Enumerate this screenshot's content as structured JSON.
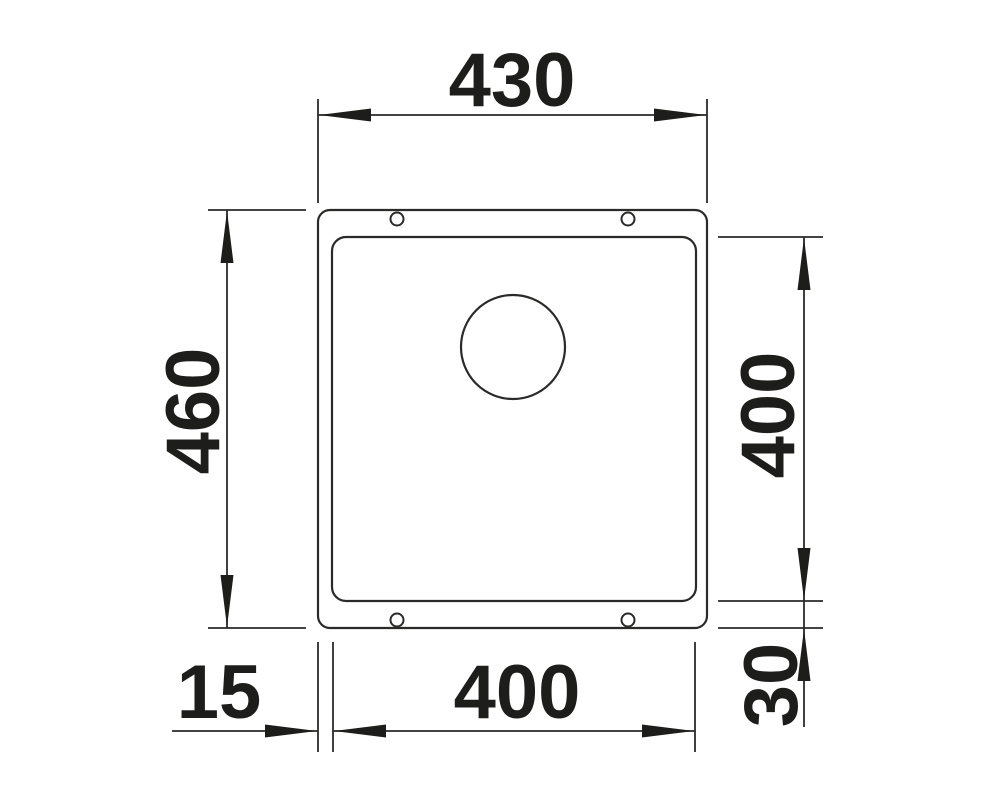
{
  "drawing": {
    "subject": "undermount-sink-top-view",
    "background": "#ffffff",
    "line_color": "#2a2a29",
    "text_color": "#1d1d1b",
    "mounting_holes_count": 4
  },
  "dimensions": {
    "overall_width_top": {
      "label": "430",
      "orientation": "horizontal",
      "position": "top"
    },
    "overall_depth_left": {
      "label": "460",
      "orientation": "vertical",
      "position": "left"
    },
    "bowl_depth_right": {
      "label": "400",
      "orientation": "vertical",
      "position": "right"
    },
    "flange_offset_bottom_right": {
      "label": "30",
      "orientation": "vertical",
      "position": "bottom-right"
    },
    "bowl_width_bottom": {
      "label": "400",
      "orientation": "horizontal",
      "position": "bottom"
    },
    "flange_offset_bottom_left": {
      "label": "15",
      "orientation": "horizontal",
      "position": "bottom-left"
    }
  }
}
